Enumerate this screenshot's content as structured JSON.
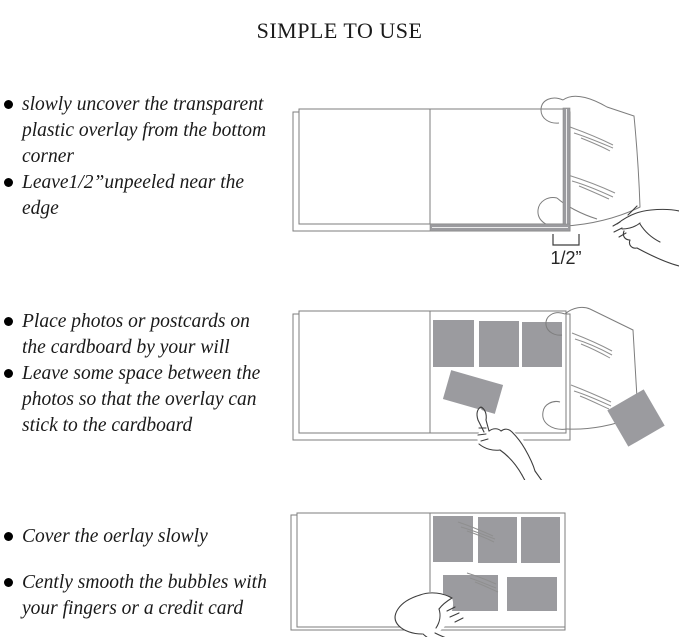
{
  "title": "SIMPLE TO USE",
  "steps": [
    {
      "bullets": [
        {
          "lines": [
            "slowly uncover the transparent",
            "plastic overlay from the bottom",
            "corner"
          ]
        },
        {
          "lines": [
            "Leave1/2”unpeeled near the",
            "edge"
          ]
        }
      ]
    },
    {
      "bullets": [
        {
          "lines": [
            "Place photos or postcards on",
            "the cardboard by your will"
          ]
        },
        {
          "lines": [
            "Leave some space between the",
            "photos so that the overlay can",
            "stick to the cardboard"
          ]
        }
      ]
    },
    {
      "bullets": [
        {
          "lines": [
            "Cover the oerlay slowly"
          ]
        },
        {
          "lines": [
            "Cently smooth the bubbles with",
            "your fingers or a credit card"
          ]
        }
      ]
    }
  ],
  "illustrations": {
    "half_inch_label": "1/2”"
  },
  "colors": {
    "photo_gray": "#9b9b9f",
    "line_color": "#7d7d7d",
    "ink": "#1a1a1a"
  }
}
